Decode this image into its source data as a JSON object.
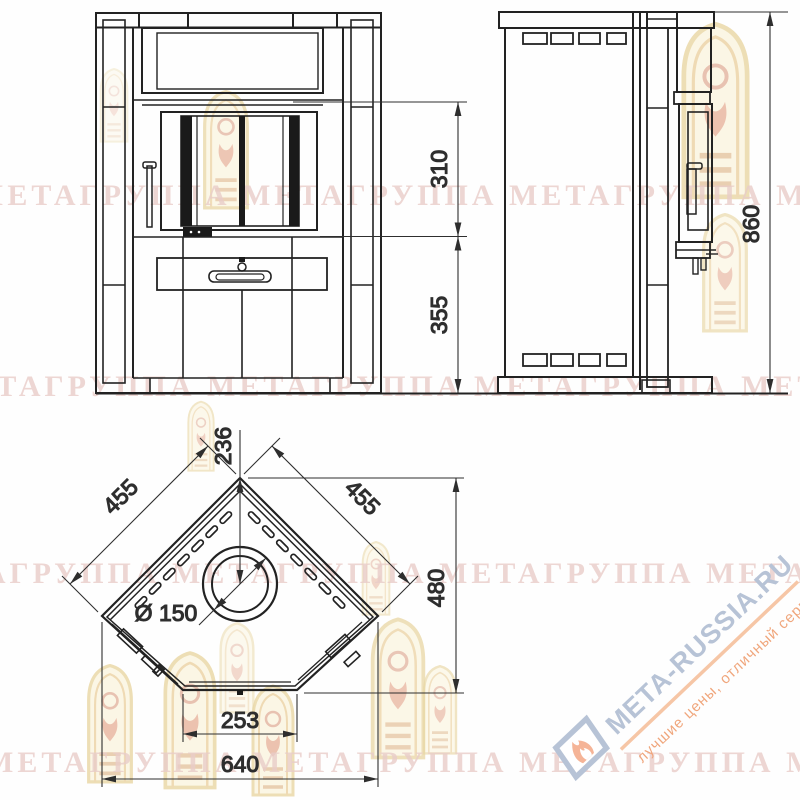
{
  "views": {
    "front": {
      "dim_upper": "310",
      "dim_lower": "355"
    },
    "side": {
      "dim_height": "860"
    },
    "plan": {
      "dim_back_to_flue": "236",
      "dim_side_left": "455",
      "dim_side_right": "455",
      "dim_depth": "480",
      "dim_flue_diameter": "Ø 150",
      "dim_front_edge": "253",
      "dim_total_width": "640"
    }
  },
  "watermark": {
    "row_text": "МЕТАГРУППА МЕТАГРУППА МЕТАГРУППА МЕТАГРУППА МЕТА",
    "site": "МЕТА-RUSSIA.RU",
    "tagline": "лучшие цены, отличный сервис!"
  },
  "colors": {
    "line": "#222222",
    "dim": "#333333",
    "watermark_pink": "#e9cdc9",
    "site_blue": "#b7c3d6",
    "accent_orange": "#f0a67c",
    "arch_cream": "#e9d7a4"
  }
}
